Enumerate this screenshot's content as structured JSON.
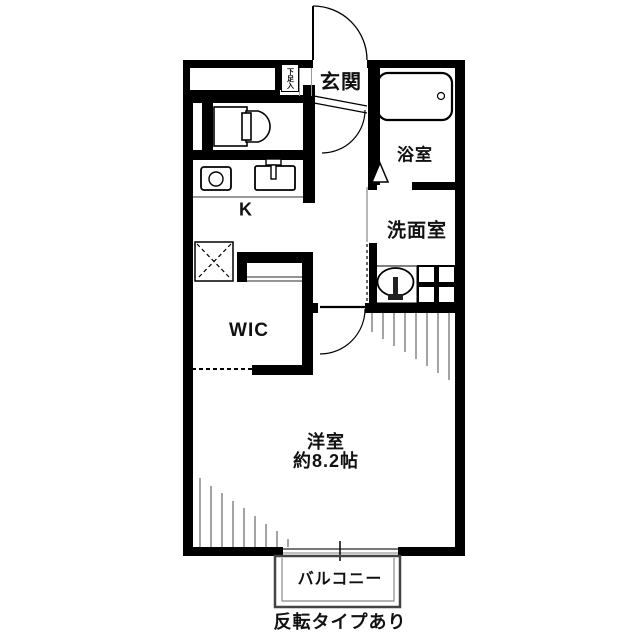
{
  "floorplan": {
    "rooms": {
      "genkan": "玄関",
      "shoe_cabinet": "下足入",
      "bathroom": "浴室",
      "washroom": "洗面室",
      "kitchen": "K",
      "wic": "WIC",
      "main_room_name": "洋室",
      "main_room_size": "約8.2帖",
      "balcony": "バルコニー"
    },
    "note": "反転タイプあり",
    "colors": {
      "wall": "#000000",
      "hatch_line": "#9a9a9a",
      "balcony_line": "#555555",
      "background": "#ffffff"
    }
  }
}
